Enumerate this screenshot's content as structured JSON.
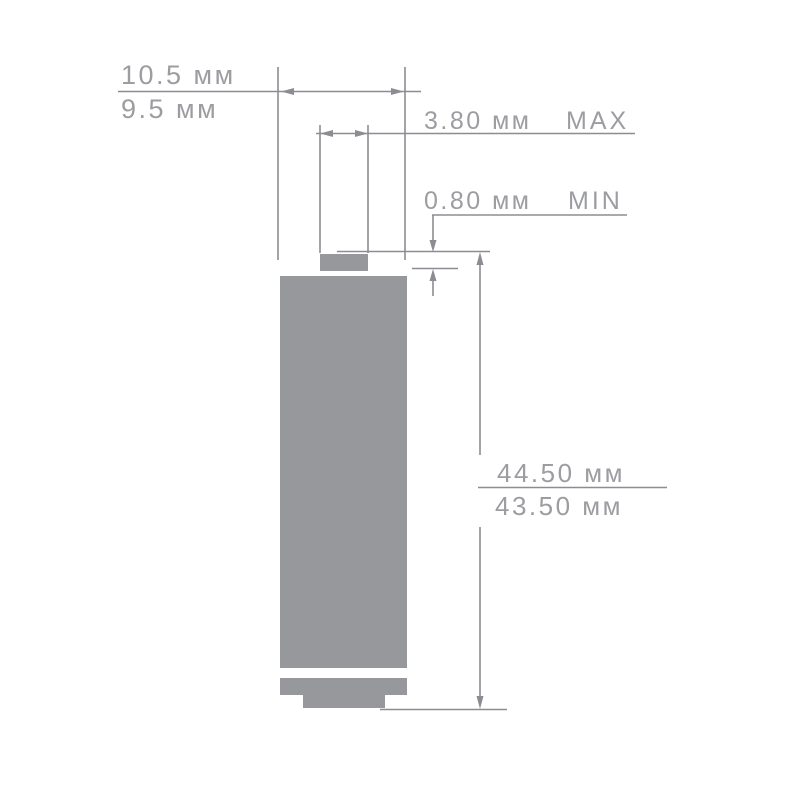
{
  "colors": {
    "battery_fill": "#97989c",
    "line": "#8c8d92",
    "text": "#9c9da1",
    "background": "#ffffff"
  },
  "dimensions": {
    "diameter": {
      "max_label": "10.5 мм",
      "min_label": "9.5 мм"
    },
    "tip_diameter": {
      "value_label": "3.80 мм",
      "qualifier": "MAX"
    },
    "tip_protrusion": {
      "value_label": "0.80 мм",
      "qualifier": "MIN"
    },
    "height": {
      "max_label": "44.50 мм",
      "min_label": "43.50 мм"
    }
  }
}
